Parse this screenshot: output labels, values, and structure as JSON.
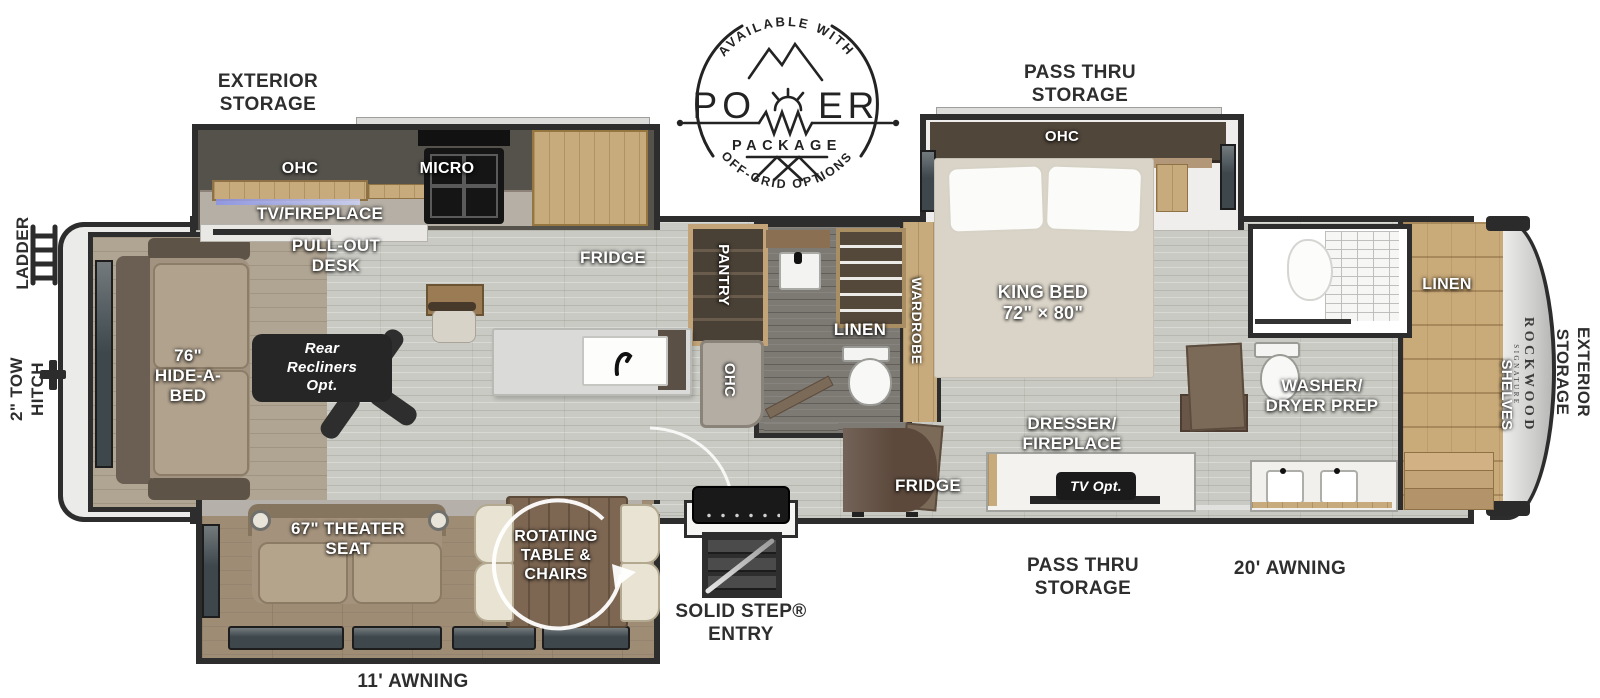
{
  "logo": {
    "available_with": "AVAILABLE WITH",
    "power_po": "PO",
    "power_er": "ER",
    "package": "PACKAGE",
    "off_grid": "OFF-GRID OPTIONS"
  },
  "left": {
    "ladder": "LADDER",
    "tow_hitch": "2\" TOW\nHITCH"
  },
  "top": {
    "exterior_storage": "EXTERIOR\nSTORAGE",
    "pass_thru": "PASS THRU\nSTORAGE"
  },
  "bottom": {
    "awning_rear": "11' AWNING",
    "solid_step": "SOLID STEP®\nENTRY",
    "pass_thru": "PASS THRU\nSTORAGE",
    "awning_front": "20' AWNING"
  },
  "rear": {
    "hide_a_bed": "76\"\nHIDE-A-\nBED",
    "recliners": "Rear\nRecliners\nOpt."
  },
  "living": {
    "theater": "67\" THEATER\nSEAT",
    "rotating": "ROTATING\nTABLE &\nCHAIRS"
  },
  "kitchen": {
    "ohc": "OHC",
    "micro": "MICRO",
    "tv_fireplace": "TV/FIREPLACE",
    "desk": "PULL-OUT\nDESK",
    "fridge": "FRIDGE",
    "pantry": "PANTRY",
    "ohc_lower": "OHC"
  },
  "bath_mid": {
    "linen": "LINEN"
  },
  "bedroom": {
    "wardrobe": "WARDROBE",
    "ohc": "OHC",
    "king_bed": "KING BED\n72\" × 80\"",
    "dresser": "DRESSER/\nFIREPLACE",
    "tv_opt": "TV Opt.",
    "fridge": "FRIDGE"
  },
  "bath_front": {
    "washer_dryer": "WASHER/\nDRYER PREP"
  },
  "front": {
    "linen": "LINEN",
    "shelves": "SHELVES",
    "brand": "ROCKWOOD",
    "brand_sub": "SIGNATURE",
    "exterior_storage": "EXTERIOR\nSTORAGE"
  }
}
